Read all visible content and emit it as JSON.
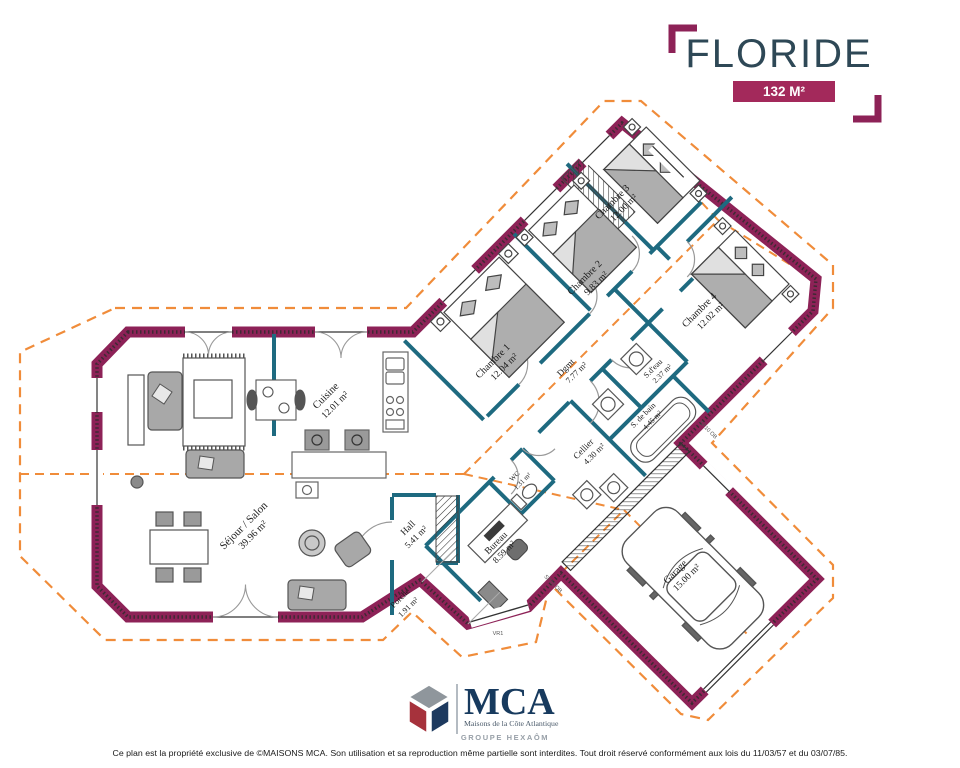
{
  "header": {
    "title": "FLORIDE",
    "area_badge": "132 M²",
    "title_color": "#2e4856",
    "accent_color": "#a3295b"
  },
  "plan": {
    "colors": {
      "exterior_wall": "#8d2257",
      "partition_wall": "#1e6a80",
      "roof_dashed": "#f08c3a"
    },
    "rooms": [
      {
        "name": "Séjour / Salon",
        "area": "39.96 m²"
      },
      {
        "name": "Cuisine",
        "area": "12.01 m²"
      },
      {
        "name": "Hall",
        "area": "5.41 m²"
      },
      {
        "name": "Porche",
        "area": "1.91 m²"
      },
      {
        "name": "Bureau",
        "area": "8.59 m²"
      },
      {
        "name": "WC",
        "area": "1.31 m²"
      },
      {
        "name": "Cellier",
        "area": "4.30 m²"
      },
      {
        "name": "Dgmt",
        "area": "7.77 m²"
      },
      {
        "name": "Chambre 1",
        "area": "12.04 m²"
      },
      {
        "name": "Chambre 2",
        "area": "9.83 m²"
      },
      {
        "name": "Chambre 3",
        "area": "12.00 m²"
      },
      {
        "name": "Chambre 4",
        "area": "12.02 m²"
      },
      {
        "name": "S.d'eau",
        "area": "2.37 m²"
      },
      {
        "name": "S. de bain",
        "area": "4.45 m²"
      },
      {
        "name": "Garage",
        "area": "15.00 m²"
      }
    ],
    "wall_labels": {
      "entrance_window": "VR1",
      "garage_wall": "SP10 OB"
    }
  },
  "footer": {
    "logo_acronym": "MCA",
    "logo_name": "Maisons de la Côte Atlantique",
    "logo_group": "GROUPE HEXAÔM",
    "legal": "Ce plan est la propriété exclusive de ©MAISONS MCA. Son utilisation et sa reproduction même partielle sont interdites. Tout droit réservé conformément aux lois du 11/03/57 et du 03/07/85."
  }
}
